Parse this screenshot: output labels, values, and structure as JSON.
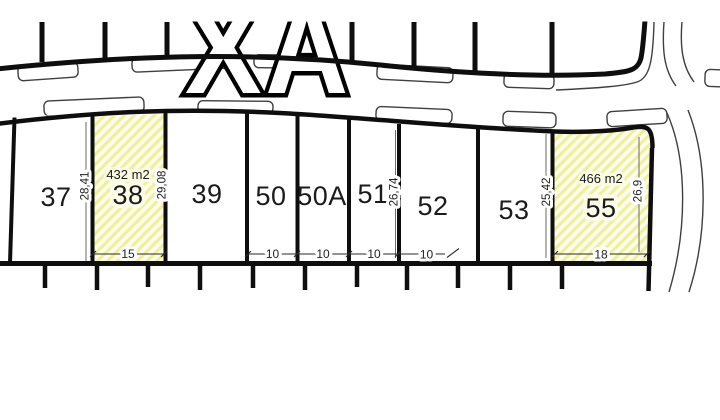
{
  "drawing": {
    "street_label": "XA",
    "plots": [
      {
        "label": "37"
      },
      {
        "label": "38",
        "area": "432 m2",
        "width_dim": "15",
        "left_dim": "28,41",
        "right_dim": "29,08",
        "highlighted": true
      },
      {
        "label": "39"
      },
      {
        "label": "50",
        "width_dim": "10"
      },
      {
        "label": "50A",
        "width_dim": "10"
      },
      {
        "label": "51",
        "width_dim": "10",
        "right_dim": "26,74"
      },
      {
        "label": "52",
        "width_dim": "10"
      },
      {
        "label": "53",
        "right_dim": "25,42"
      },
      {
        "label": "55",
        "area": "466 m2",
        "width_dim": "18",
        "right_dim": "26,9",
        "highlighted": true
      }
    ],
    "colors": {
      "highlight_fill": "#fcfce9",
      "hatch_stripe": "#eeefa0",
      "line": "#111111",
      "thin_line": "#444444",
      "background": "#ffffff"
    }
  }
}
